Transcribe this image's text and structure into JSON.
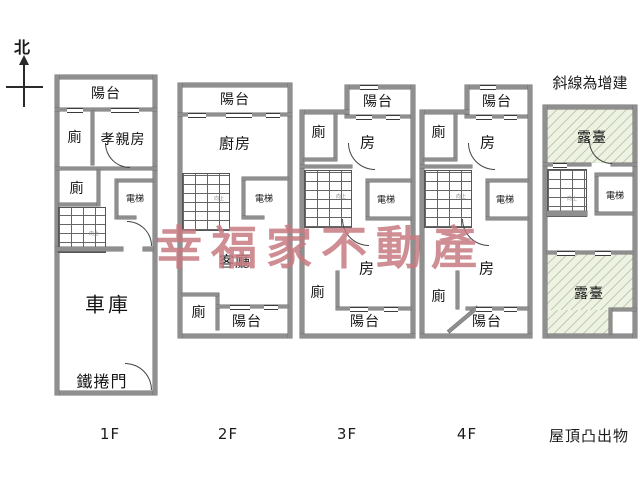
{
  "compass": {
    "north_label": "北"
  },
  "legend": {
    "note": "斜線為增建",
    "stair_note": "向上"
  },
  "watermark": {
    "text": "幸福家不動產",
    "color": "#c77a80"
  },
  "palette": {
    "wall": "#8f8f8f",
    "line": "#444444",
    "terrace_fill": "#edf2e2",
    "terrace_hatch": "#8ca073",
    "label": "#141414"
  },
  "floors": [
    {
      "caption": "1F",
      "rooms": {
        "balcony": "陽台",
        "toilet_upper": "廁",
        "parents_room": "孝親房",
        "toilet_lower": "廁",
        "elevator": "電梯",
        "garage": "車庫",
        "roller_door": "鐵捲門"
      }
    },
    {
      "caption": "2F",
      "rooms": {
        "balcony_top": "陽台",
        "kitchen": "廚房",
        "elevator": "電梯",
        "living_room": "客廳",
        "toilet": "廁",
        "balcony_bottom": "陽台"
      }
    },
    {
      "caption": "3F",
      "rooms": {
        "balcony_top": "陽台",
        "toilet_top": "廁",
        "room_top": "房",
        "elevator": "電梯",
        "room_bottom": "房",
        "toilet_bottom": "廁",
        "balcony_bottom": "陽台"
      }
    },
    {
      "caption": "4F",
      "rooms": {
        "balcony_top": "陽台",
        "toilet_top": "廁",
        "room_top": "房",
        "elevator": "電梯",
        "room_bottom": "房",
        "toilet_bottom": "廁",
        "balcony_bottom": "陽台"
      }
    },
    {
      "caption": "屋頂凸出物",
      "rooms": {
        "terrace_top": "露臺",
        "elevator": "電梯",
        "terrace_bottom": "露臺"
      }
    }
  ]
}
